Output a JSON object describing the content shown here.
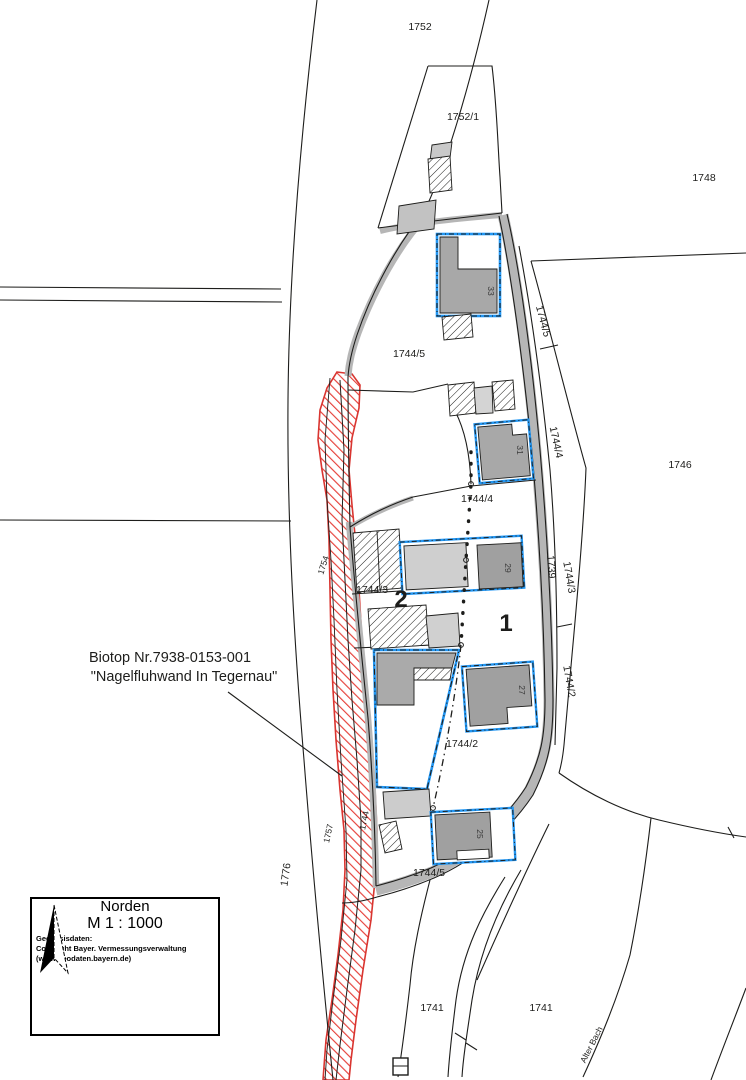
{
  "map": {
    "parcel_labels": [
      "1752",
      "1752/1",
      "1748",
      "1746",
      "1744/5",
      "1744/5",
      "1744/4",
      "1744/4",
      "1739",
      "1744/3",
      "1744/3",
      "1744/2",
      "1744/2",
      "1744/5",
      "1741",
      "1741",
      "1776",
      "1757",
      "1744",
      "1754",
      "Alter Bach"
    ],
    "house_numbers": [
      "33",
      "31",
      "29",
      "27",
      "25"
    ],
    "zone_numbers": {
      "zone2": "2",
      "zone1": "1"
    },
    "biotope_annotation": {
      "line1": "Biotop Nr.7938-0153-001",
      "line2": "\"Nagelfluhwand In Tegernau\""
    },
    "legend": {
      "north_label": "Norden",
      "scale_label": "M 1 : 1000",
      "attribution": {
        "line1": "Geobasisdaten:",
        "line2": "Copyright Bayer. Vermessungsverwaltung",
        "line3": "(www.geodaten.bayern.de)"
      }
    },
    "colors": {
      "biotope_red": "#e6403a",
      "biotope_border_red": "#d93530",
      "building_outline_blue": "#2196f3",
      "building_dark_gray": "#a0a0a0",
      "building_mid_gray": "#a9a9a9",
      "building_light_gray": "#d2d2d2",
      "road_gray": "#b6b6b6",
      "line_black": "#1d1d1b"
    }
  }
}
